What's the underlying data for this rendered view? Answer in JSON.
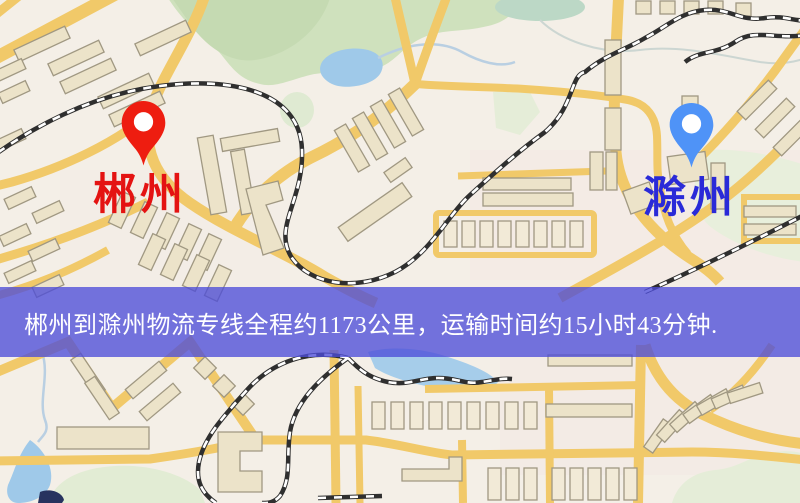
{
  "map": {
    "origin": {
      "name": "郴州",
      "pin_color": "#ee1d10",
      "label_color": "#e41312"
    },
    "destination": {
      "name": "滁州",
      "pin_color": "#4f93f7",
      "label_color": "#2a2ad8"
    },
    "banner": {
      "text": "郴州到滁州物流专线全程约1173公里，运输时间约15小时43分钟.",
      "background_color": "rgba(77,77,216,0.78)",
      "text_color": "#ffffff",
      "distance_km": 1173,
      "duration_hours": 15,
      "duration_minutes": 43
    }
  },
  "palette": {
    "map_background": "#f4efe7",
    "road_yellow": "#f1c969",
    "building_fill": "#ece3c9",
    "building_fill_light": "#f2ead7",
    "building_stroke": "#a09882",
    "park_green": "#cfe1bd",
    "pale_green": "#e5edd8",
    "water_blue": "#9fc9e9",
    "railway_dark": "#2f2f2f"
  }
}
